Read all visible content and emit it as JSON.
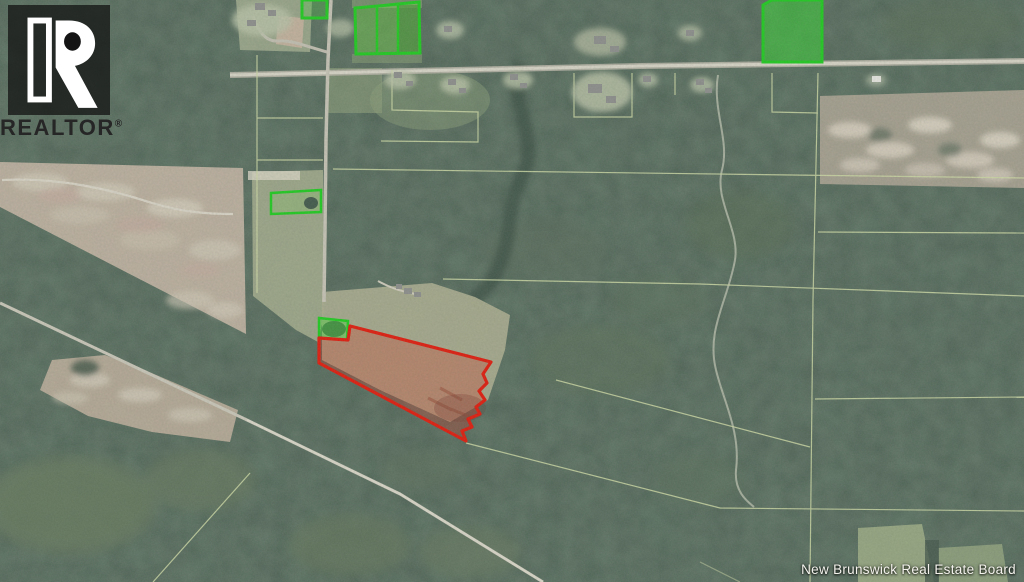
{
  "branding": {
    "logo_text": "REALTOR",
    "registered_mark": "®"
  },
  "attribution": {
    "text": "New Brunswick Real Estate Board"
  },
  "map": {
    "colors": {
      "subject_outline": "#e1190c",
      "subject_fill": "rgba(216,45,30,0.30)",
      "highlight_outline": "#1fca1f",
      "survey_line": "#cdd7a4",
      "road": "#d7d3c6"
    },
    "parcels": {
      "subject_count": 1,
      "highlighted_count": 5
    }
  }
}
